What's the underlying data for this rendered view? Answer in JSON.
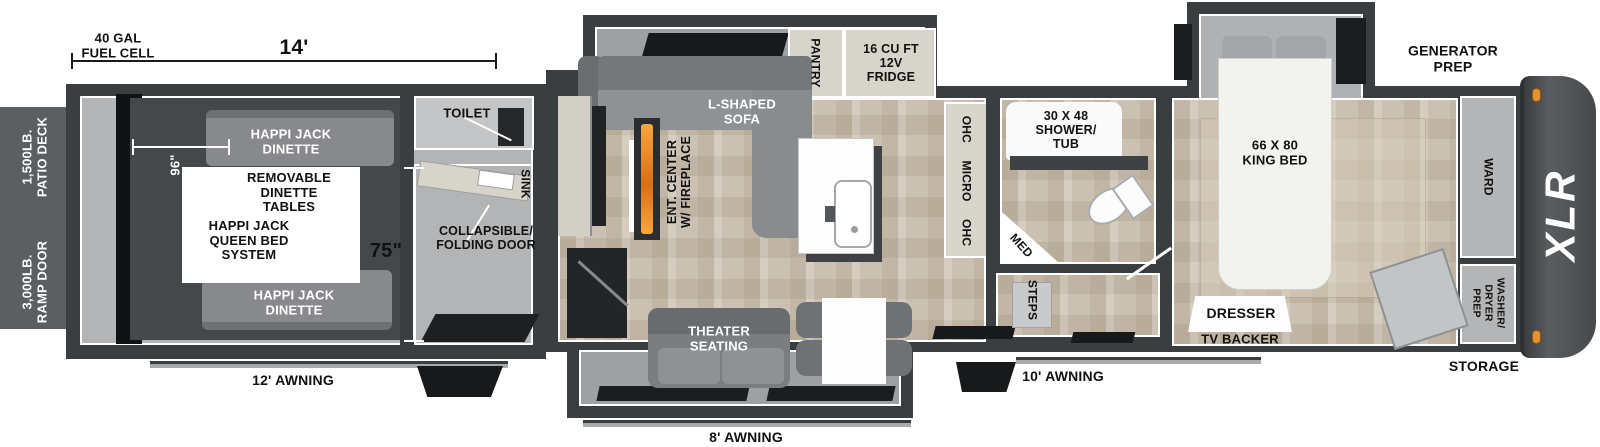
{
  "brand": {
    "logo": "XLR"
  },
  "exterior": {
    "fuel_cell": "40 GAL\nFUEL CELL",
    "garage_length": "14'",
    "generator_prep": "GENERATOR\nPREP",
    "patio_deck": "1,500LB.\nPATIO DECK",
    "ramp_door": "3,000LB.\nRAMP DOOR",
    "storage": "STORAGE",
    "awning_rear": "12' AWNING",
    "awning_mid": "8' AWNING",
    "awning_front": "10' AWNING"
  },
  "garage": {
    "dim_width": "96\"",
    "dim_height": "75\"",
    "dinette_top": "HAPPI JACK\nDINETTE",
    "dinette_bottom": "HAPPI JACK\nDINETTE",
    "removable_tables": "REMOVABLE\nDINETTE\nTABLES",
    "queen_bed_system": "HAPPI JACK\nQUEEN BED\nSYSTEM",
    "toilet": "TOILET",
    "sink": "SINK",
    "folding_door": "COLLAPSIBLE/\nFOLDING DOOR"
  },
  "living": {
    "sofa": "L-SHAPED\nSOFA",
    "ent_center": "ENT. CENTER\nW/ FIREPLACE",
    "theater_seating": "THEATER\nSEATING",
    "pantry": "PANTRY",
    "fridge": "16 CU FT\n12V\nFRIDGE",
    "overhead_row": "OHC MICRO OHC"
  },
  "bathroom": {
    "shower": "30 X 48\nSHOWER/\nTUB",
    "med": "MED",
    "steps": "STEPS"
  },
  "bedroom": {
    "king_bed": "66 X 80\nKING BED",
    "dresser": "DRESSER",
    "tv_backer": "TV BACKER",
    "ward": "WARD",
    "washer_dryer": "WASHER/\nDRYER\nPREP"
  },
  "colors": {
    "wall": "#3b3e41",
    "interior_gray": "#b3b4b6",
    "wood_floor": "#cfc6b7",
    "cabinet_cream": "#d7d4c9",
    "flame_orange": "#e8922d",
    "marker_light": "#e5912d"
  }
}
